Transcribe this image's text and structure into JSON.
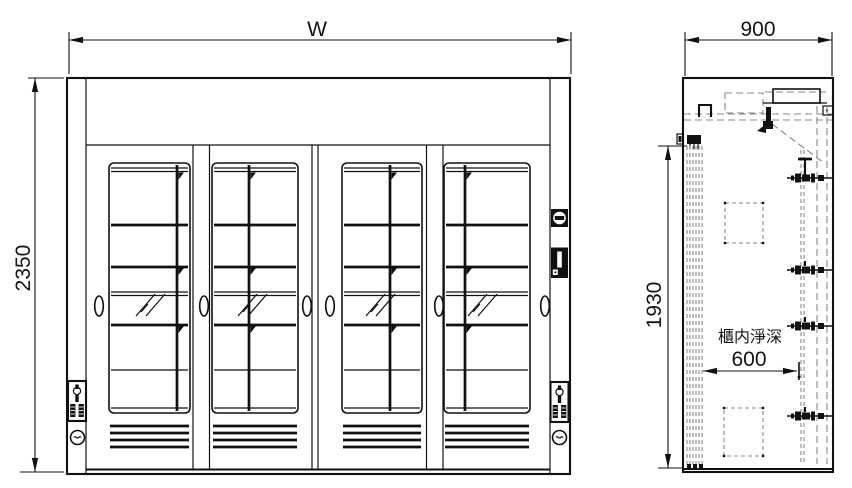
{
  "drawing": {
    "type": "technical-cad-drawing",
    "background": "#ffffff",
    "line_color": "#111111",
    "hidden_line_color": "#8a8a8a",
    "views": {
      "front": {
        "name": "front-elevation",
        "door_count": 4
      },
      "side": {
        "name": "side-section"
      }
    },
    "dimensions": {
      "width": "W",
      "height": "2350",
      "depth": "900",
      "internal_height": "1930",
      "internal_depth_caption": "櫃内淨深",
      "internal_depth": "600"
    }
  }
}
